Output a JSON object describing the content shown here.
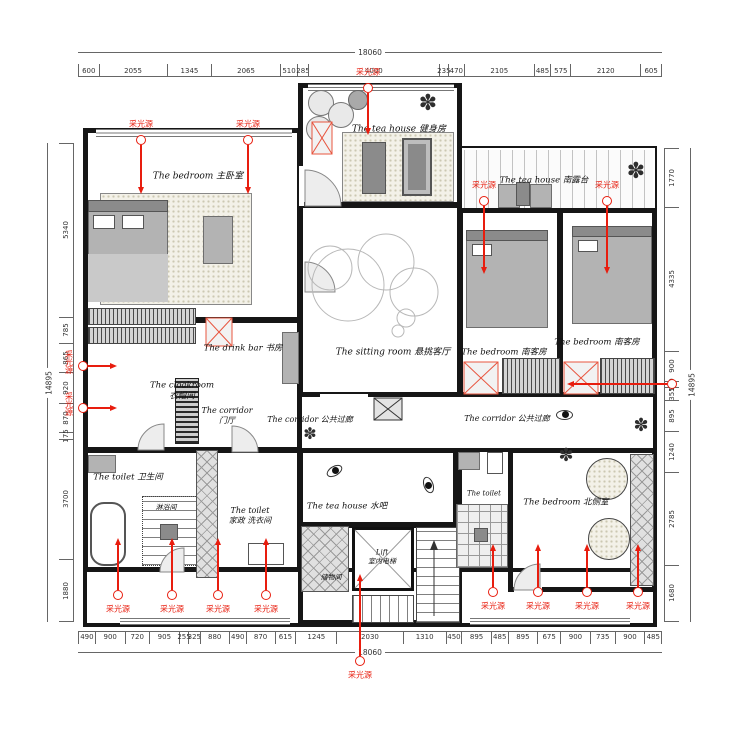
{
  "annotations": {
    "light_label": "采光源",
    "light_color": "#e81d0e"
  },
  "dimensions": {
    "top": {
      "total": "18060",
      "segments": [
        600,
        2055,
        1345,
        2065,
        510,
        285,
        4000,
        235,
        470,
        2105,
        485,
        575,
        2120,
        605
      ]
    },
    "bottom": {
      "total": "18060",
      "segments": [
        490,
        900,
        720,
        905,
        255,
        325,
        880,
        490,
        870,
        615,
        1245,
        2030,
        1310,
        450,
        895,
        485,
        895,
        675,
        900,
        735,
        900,
        485
      ]
    },
    "left": {
      "total": "14895",
      "segments": [
        5340,
        785,
        865,
        920,
        870,
        175,
        3700,
        1880
      ]
    },
    "right": {
      "total": "14895",
      "segments": [
        1770,
        4335,
        900,
        160,
        355,
        895,
        1240,
        2785,
        1680
      ]
    }
  },
  "rooms": [
    {
      "label": "The bedroom 主卧室",
      "x": 198,
      "y": 177,
      "fs": 9
    },
    {
      "label": "The tea house 健身房",
      "x": 399,
      "y": 130,
      "fs": 9
    },
    {
      "label": "The tea house 南露台",
      "x": 544,
      "y": 181,
      "fs": 8.5
    },
    {
      "label": "The sitting room  悬挑客厅",
      "x": 393,
      "y": 353,
      "fs": 9
    },
    {
      "label": "The bedroom 南客房",
      "x": 504,
      "y": 353,
      "fs": 8.5
    },
    {
      "label": "The bedroom 南客房",
      "x": 597,
      "y": 343,
      "fs": 8.5
    },
    {
      "label": "The drink bar 书房",
      "x": 243,
      "y": 349,
      "fs": 8.5
    },
    {
      "label": "The cloakroom\n衣帽间",
      "x": 182,
      "y": 391,
      "fs": 8.5
    },
    {
      "label": "The corridor\n门厅",
      "x": 227,
      "y": 416,
      "fs": 8
    },
    {
      "label": "The corridor 公共过廊",
      "x": 310,
      "y": 420,
      "fs": 8
    },
    {
      "label": "The corridor 公共过廊",
      "x": 507,
      "y": 419,
      "fs": 8
    },
    {
      "label": "The toilet 卫生间",
      "x": 128,
      "y": 478,
      "fs": 8.5
    },
    {
      "label": "淋浴间",
      "x": 166,
      "y": 508,
      "fs": 7
    },
    {
      "label": "The toilet\n家政 洗衣间",
      "x": 250,
      "y": 516,
      "fs": 8
    },
    {
      "label": "The tea house 水吧",
      "x": 347,
      "y": 507,
      "fs": 8.5
    },
    {
      "label": "Lift\n室内电梯",
      "x": 382,
      "y": 557,
      "fs": 7
    },
    {
      "label": "储物间",
      "x": 331,
      "y": 578,
      "fs": 7
    },
    {
      "label": "The toilet",
      "x": 484,
      "y": 494,
      "fs": 7
    },
    {
      "label": "The bedroom 北侧室",
      "x": 566,
      "y": 503,
      "fs": 8.5
    }
  ],
  "lights": [
    {
      "x": 368,
      "y": 88,
      "dir": "down",
      "len": 35,
      "label_side": "above"
    },
    {
      "x": 141,
      "y": 140,
      "dir": "down",
      "len": 42,
      "label_side": "above"
    },
    {
      "x": 248,
      "y": 140,
      "dir": "down",
      "len": 42,
      "label_side": "above"
    },
    {
      "x": 484,
      "y": 201,
      "dir": "down",
      "len": 61,
      "label_side": "above"
    },
    {
      "x": 607,
      "y": 201,
      "dir": "down",
      "len": 61,
      "label_side": "above"
    },
    {
      "x": 672,
      "y": 384,
      "dir": "left",
      "len": 93,
      "label_side": "none"
    },
    {
      "x": 83,
      "y": 366,
      "dir": "right",
      "len": 22,
      "label_side": "left"
    },
    {
      "x": 83,
      "y": 408,
      "dir": "right",
      "len": 22,
      "label_side": "left"
    },
    {
      "x": 118,
      "y": 595,
      "dir": "up",
      "len": 45,
      "label_side": "below"
    },
    {
      "x": 172,
      "y": 595,
      "dir": "up",
      "len": 45,
      "label_side": "below"
    },
    {
      "x": 218,
      "y": 595,
      "dir": "up",
      "len": 45,
      "label_side": "below"
    },
    {
      "x": 266,
      "y": 595,
      "dir": "up",
      "len": 45,
      "label_side": "below"
    },
    {
      "x": 493,
      "y": 592,
      "dir": "up",
      "len": 36,
      "label_side": "below"
    },
    {
      "x": 538,
      "y": 592,
      "dir": "up",
      "len": 36,
      "label_side": "below"
    },
    {
      "x": 587,
      "y": 592,
      "dir": "up",
      "len": 36,
      "label_side": "below"
    },
    {
      "x": 638,
      "y": 592,
      "dir": "up",
      "len": 36,
      "label_side": "below"
    },
    {
      "x": 360,
      "y": 661,
      "dir": "up",
      "len": 75,
      "label_side": "below"
    }
  ]
}
